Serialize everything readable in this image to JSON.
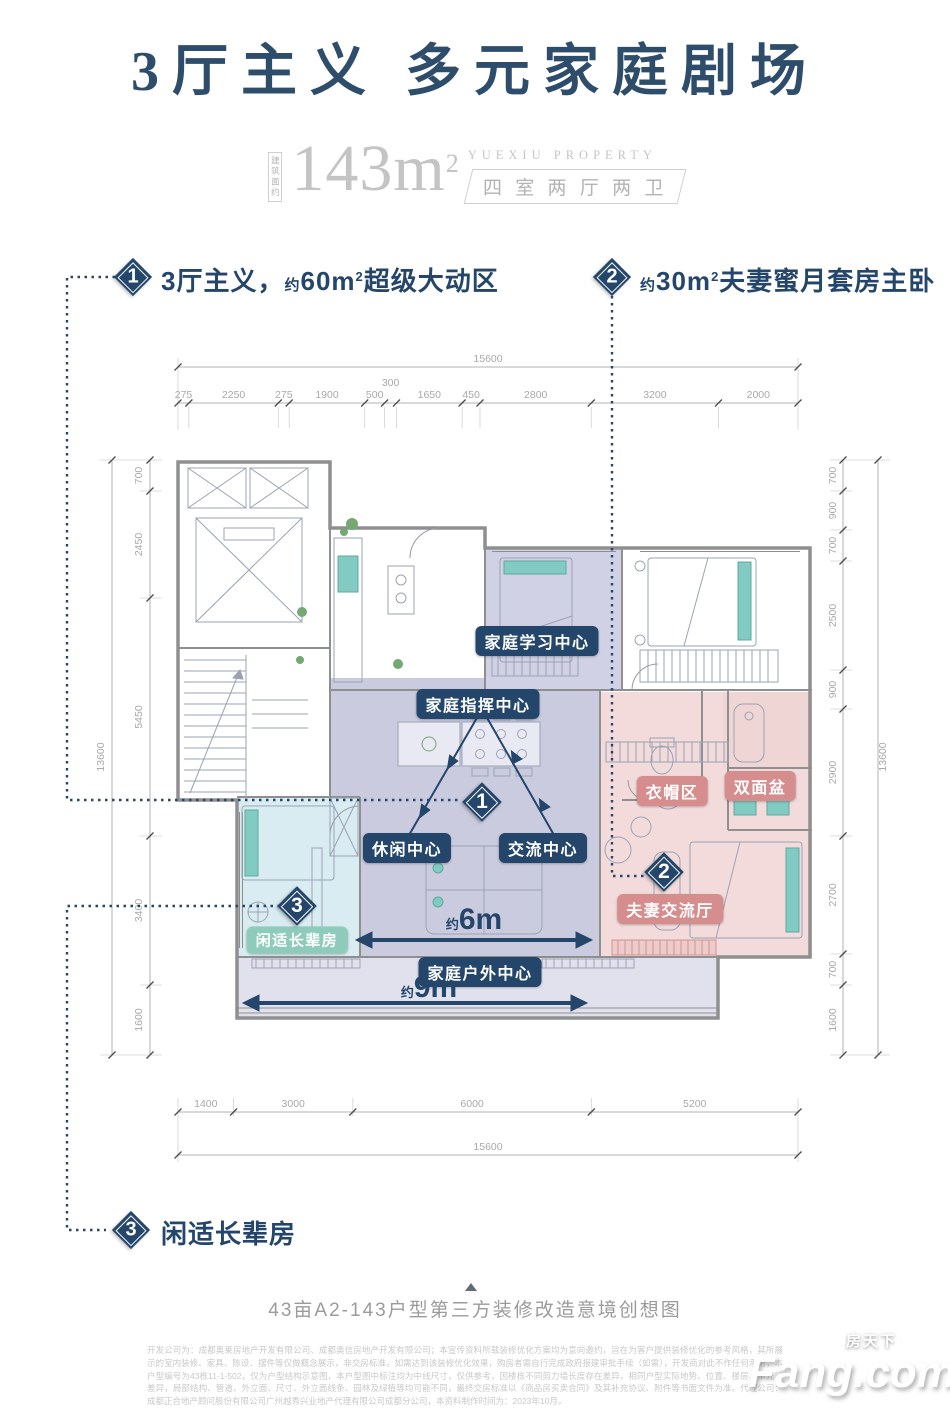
{
  "colors": {
    "navy": "#24466b",
    "title_blue": "#2e4d6b",
    "pink_badge": "#d68d8e",
    "teal_badge": "#8ecbbb",
    "lavender_room": "#cbcbe0",
    "pink_room": "#f3dbdb",
    "teal_room": "#d9ecf1"
  },
  "header": {
    "title_part1": "3厅主义",
    "title_part2": "多元家庭剧场",
    "area_label": "建筑面约",
    "area_value": "143m",
    "area_sup": "2",
    "brand": "YUEXIU PROPERTY",
    "rooms": "四 室 两 厅 两 卫"
  },
  "callouts": {
    "c1": {
      "num": "1",
      "t1": "3厅主义，",
      "approx": "约",
      "area": "60m",
      "sup": "2",
      "t2": "超级大动区"
    },
    "c2": {
      "num": "2",
      "approx": "约",
      "area": "30m",
      "sup": "2",
      "t2": "夫妻蜜月套房主卧"
    },
    "c3": {
      "num": "3",
      "label": "闲适长辈房"
    }
  },
  "plan": {
    "badges": {
      "study": "家庭学习中心",
      "command": "家庭指挥中心",
      "leisure": "休闲中心",
      "social": "交流中心",
      "outdoor": "家庭户外中心",
      "cloak": "衣帽区",
      "basin": "双面盆",
      "couple": "夫妻交流厅",
      "elder": "闲适长辈房"
    },
    "diamonds": {
      "d1": "1",
      "d2": "2",
      "d3": "3"
    },
    "arrows": {
      "a6_approx": "约",
      "a6": "6m",
      "a9_approx": "约",
      "a9": "9m"
    }
  },
  "dims": {
    "top_total": "15600",
    "top_segments": [
      "275",
      "2250",
      "275",
      "1900",
      "500",
      "300",
      "1650",
      "450",
      "2800",
      "3200",
      "2000"
    ],
    "bottom_segments": [
      "1400",
      "3000",
      "6000",
      "5200"
    ],
    "bottom_total": "15600",
    "left_segments": [
      "700",
      "2450",
      "5450",
      "3400",
      "1600"
    ],
    "left_total": "13600",
    "right_segments": [
      "700",
      "900",
      "700",
      "2500",
      "900",
      "2900",
      "2700",
      "700",
      "1600"
    ],
    "right_total": "13600"
  },
  "footer": {
    "caption": "43亩A2-143户型第三方装修改造意境创想图",
    "disclaimer": "开发公司为：成都奥莱房地产开发有限公司、成都奥信房地产开发有限公司；本宣传资料所载装修优化方案均为意向邀约，旨在为客户提供装修优化的参考风格，其所展示的室内装修、家具、陈设、摆件等仅做概念展示，非交房标准，如需达到该装修优化效果，购房者需自行完成政府报建审批手续（如需），开发商对此不作任何承诺；本户型编号为43栋11-1-502，仅为户型结构示意图，本户型图中标注均为中线尺寸，仅供参考，因楼栋不同剪力墙长度存在差异，相同户型实际地势、位置、楼层、单元等差异，局部结构、管道、外立面、尺寸、外立面线条、园林及绿植等均可能不同，最终交房标准以《商品房买卖合同》及其补充协议、附件等书面文件为准。代理公司：成都正合地产顾问股份有限公司广州越秀兴业地产代理有限公司成都分公司，本资料制作时间为：2023年10月。",
    "watermark_cn": "房天下",
    "watermark_en": "Fang.com"
  }
}
